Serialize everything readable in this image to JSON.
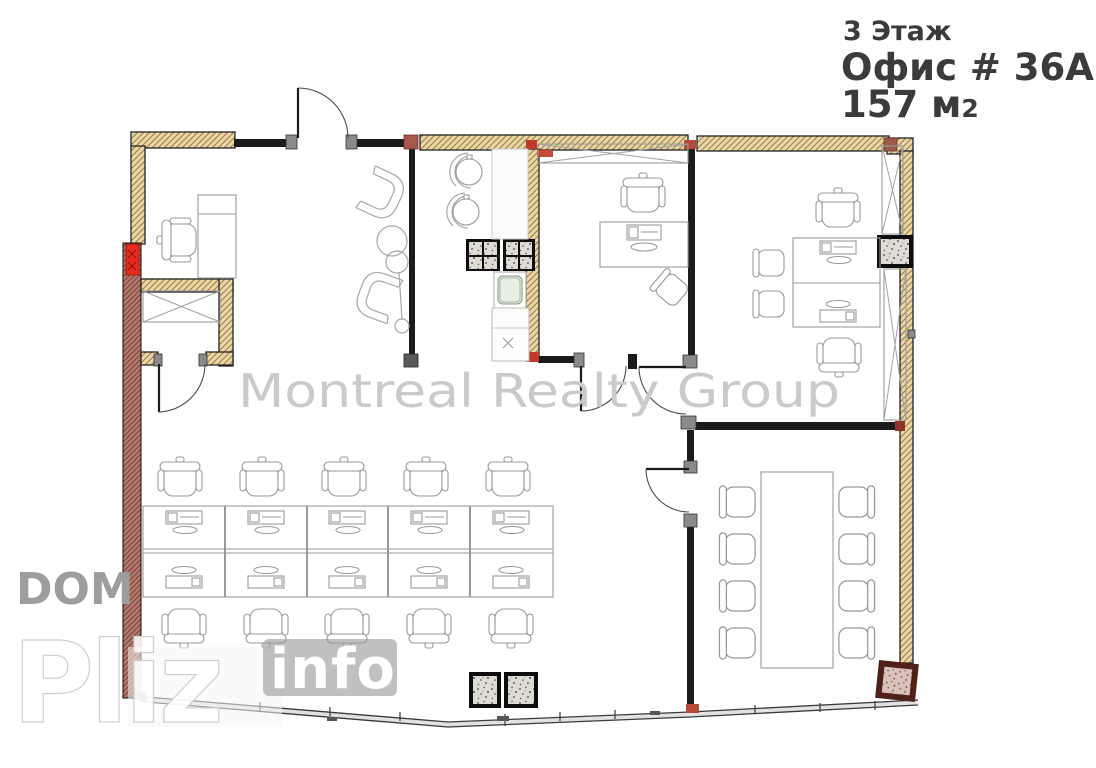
{
  "title": {
    "floor_line": "3 Этаж",
    "office_line": "Офис # 36А",
    "area_value": "157 м",
    "area_exponent": "2"
  },
  "watermarks": {
    "center": "Montreal Realty Group",
    "side": "DOM",
    "brand_large": "Pliz",
    "brand_small": "info"
  },
  "colors": {
    "wall_tan": "#ead7a4",
    "wall_tan_hatch": "#97794a",
    "wall_exterior_brown": "#b47a6e",
    "wall_exterior_hatch": "#77443a",
    "wall_interior_black": "#1b1b1b",
    "radiator_red": "#e8291c",
    "junction_accent": "#c0392b",
    "furniture_line_gray": "#9a9a9a",
    "watermark_gray": "#cacaca",
    "title_text": "#3b3b3b",
    "sink_green": "#ddeadd"
  },
  "plan": {
    "type": "office-floor-plan",
    "rooms": [
      {
        "name": "reception-lounge",
        "symbols": [
          "desk",
          "office-chair",
          "tub-chair x2",
          "coffee-table",
          "floor-lamp",
          "closet-x-box",
          "radiator"
        ]
      },
      {
        "name": "kitchenette",
        "symbols": [
          "stool x2",
          "counter",
          "sink",
          "shaft-column x2"
        ]
      },
      {
        "name": "private-office",
        "symbols": [
          "wardrobe-x",
          "desk",
          "office-chair",
          "guest-chair"
        ]
      },
      {
        "name": "team-office",
        "symbols": [
          "desk x2",
          "office-chair x2",
          "guest-chair x2",
          "wardrobe-x x2",
          "concrete-column"
        ]
      },
      {
        "name": "open-office",
        "symbols": [
          "workstation x10",
          "office-chair x10",
          "concrete-column x2"
        ]
      },
      {
        "name": "meeting-room",
        "symbols": [
          "conference-table",
          "chair x8",
          "concrete-column",
          "door"
        ]
      }
    ]
  }
}
